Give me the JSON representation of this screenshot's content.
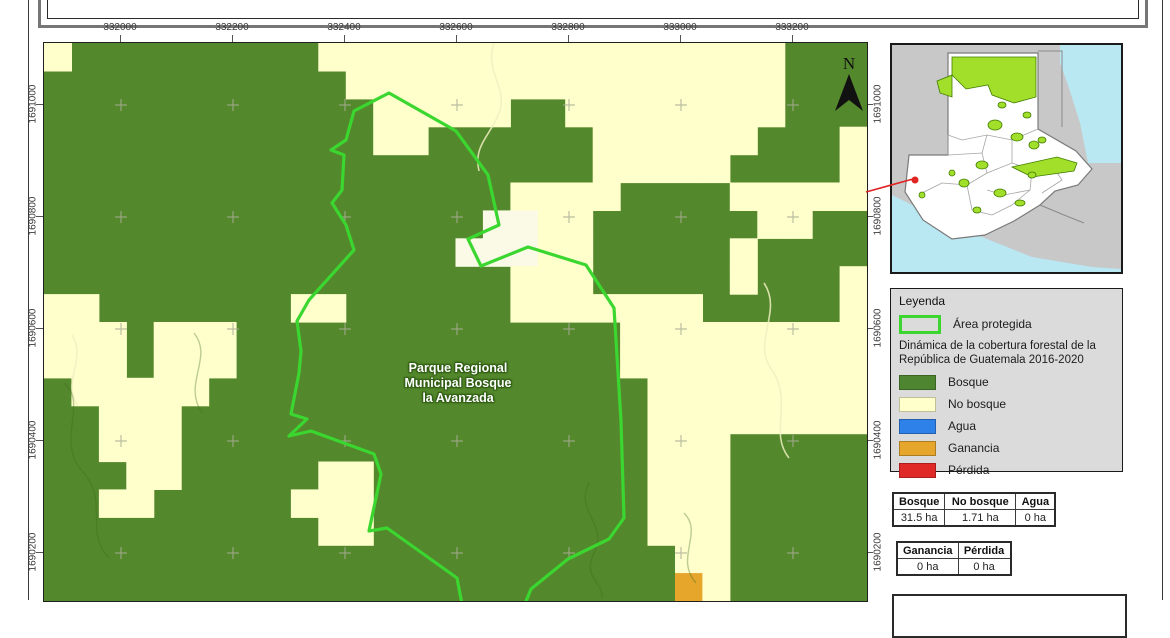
{
  "axes": {
    "top": {
      "labels": [
        "332000",
        "332200",
        "332400",
        "332600",
        "332800",
        "333000",
        "333200"
      ]
    },
    "left": {
      "labels": [
        "1691000",
        "1690800",
        "1690600",
        "1690400",
        "1690200"
      ]
    },
    "right": {
      "labels": [
        "1691000",
        "1690800",
        "1690600",
        "1690400",
        "1690200"
      ]
    }
  },
  "map": {
    "label_lines": [
      "Parque Regional",
      "Municipal Bosque",
      "la Avanzada"
    ],
    "north_label": "N",
    "colors": {
      "bosque": "#54882c",
      "no_bosque": "#ffffcc",
      "claro": "#fafae6",
      "ganancia": "#e6a62c",
      "outline": "#3bd62f",
      "cross": "#a9ae96"
    },
    "raster_rows": [
      "NBBBBBBBBBNNNNNNNNNNNNNNNNNBBB",
      "BBBBBBBBBBBNNNNNNNNNNNNNNNNBBB",
      "BBBBBBBBBBBBNNNNNBBNNNNNNNNBBB",
      "BBBBBBBBBBBBNNBBBBBBNNNNNNBBBN",
      "BBBBBBBBBBBBBBBBBBBBNNNNNBBBBN",
      "BBBBBBBBBBBBBBBBBNNNNBBBBNNNNN",
      "BBBBBBBBBBBBBBBBWWNNBBBBBBNNBB",
      "BBBBBBBBBBBBBBBWWWNNBBBBBNBBBB",
      "BBBBBBBBBBBBBBBBBNNNBBBBBNBBBN",
      "NNBBBBBBBNNBBBBBBNNNNNNNBBBBBN",
      "NNNBNNNBBBBBBBBBBBBBBNNNNNNNNN",
      "NNNBNNNBBBBBBBBBBBBBBNNNNNNNNN",
      "BNNNNNBBBBBBBBBBBBBBBBNNNNNNNN",
      "BBNNNBBBBBBBBBBBBBBBBBNNNNNNNN",
      "BBNNNBBBBBBBBBBBBBBBBBNNNBBBBB",
      "BBBNNBBBBBNNBBBBBBBBBBNNNBBBBB",
      "BBNNBBBBBNNNBBBBBBBBBBNNNBBBBB",
      "BBBBBBBBBBNNBBBBBBBBBBNNNBBBBB",
      "BBBBBBBBBBBBBBBBBBBBBBBNNBBBBB",
      "BBBBBBBBBBBBBBBBBBBBBBBGNBBBBB"
    ],
    "outline_points": [
      [
        345,
        50
      ],
      [
        310,
        68
      ],
      [
        302,
        97
      ],
      [
        287,
        107
      ],
      [
        300,
        112
      ],
      [
        298,
        147
      ],
      [
        288,
        160
      ],
      [
        302,
        182
      ],
      [
        310,
        207
      ],
      [
        265,
        257
      ],
      [
        253,
        278
      ],
      [
        257,
        308
      ],
      [
        255,
        330
      ],
      [
        247,
        371
      ],
      [
        263,
        376
      ],
      [
        245,
        393
      ],
      [
        267,
        388
      ],
      [
        330,
        411
      ],
      [
        337,
        431
      ],
      [
        325,
        488
      ],
      [
        343,
        485
      ],
      [
        413,
        535
      ],
      [
        425,
        598
      ],
      [
        440,
        612
      ],
      [
        473,
        580
      ],
      [
        487,
        546
      ],
      [
        524,
        516
      ],
      [
        565,
        496
      ],
      [
        580,
        475
      ],
      [
        577,
        378
      ],
      [
        570,
        265
      ],
      [
        542,
        222
      ],
      [
        484,
        204
      ],
      [
        437,
        223
      ],
      [
        424,
        196
      ],
      [
        455,
        182
      ],
      [
        444,
        132
      ],
      [
        412,
        88
      ]
    ],
    "cross_xs": [
      77,
      189,
      301,
      413,
      525,
      637,
      749
    ],
    "cross_ys": [
      62,
      174,
      286,
      398,
      510
    ]
  },
  "inset": {
    "colors": {
      "neighbor_land": "#c8c8c8",
      "country_fill": "#ffffff",
      "water": "#b9e7f2",
      "protected": "#a2df2a",
      "protected_stroke": "#3f7d00",
      "indicator_red": "#e02423"
    }
  },
  "legend": {
    "title": "Leyenda",
    "protected_label": "Área protegida",
    "dynamics_lines": [
      "Dinámica de la cobertura forestal de la",
      "República de Guatemala 2016-2020"
    ],
    "classes": [
      {
        "label": "Bosque",
        "color": "#4e8531"
      },
      {
        "label": "No bosque",
        "color": "#ffffcc"
      },
      {
        "label": "Agua",
        "color": "#2e81e8"
      },
      {
        "label": "Ganancia",
        "color": "#e6a62c"
      },
      {
        "label": "Pérdida",
        "color": "#e02a28"
      }
    ]
  },
  "tables": {
    "cover": {
      "headers": [
        "Bosque",
        "No bosque",
        "Agua"
      ],
      "values": [
        "31.5 ha",
        "1.71 ha",
        "0 ha"
      ]
    },
    "change": {
      "headers": [
        "Ganancia",
        "Pérdida"
      ],
      "values": [
        "0 ha",
        "0 ha"
      ]
    }
  }
}
